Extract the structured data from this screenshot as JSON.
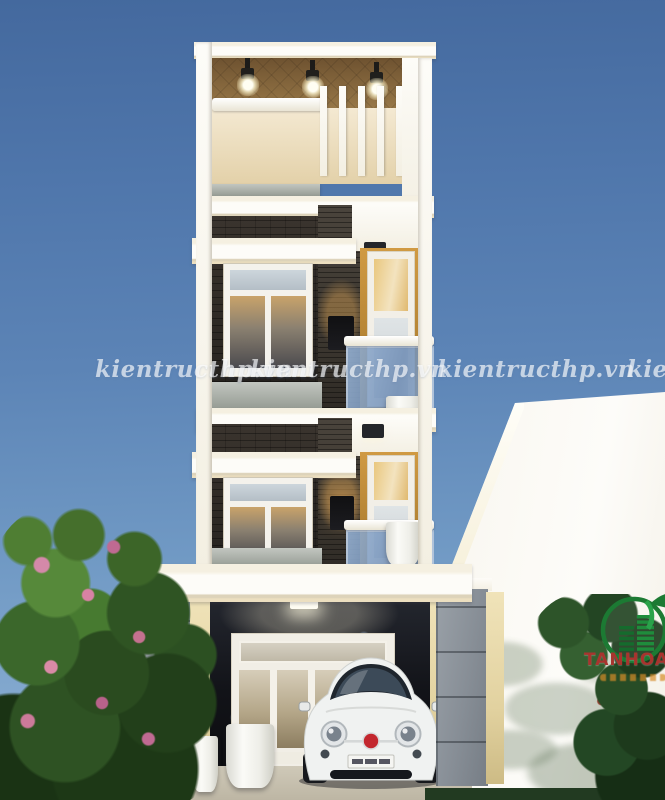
{
  "watermark": {
    "text": "kientructhp.vn",
    "count": 4
  },
  "brand": {
    "name": "TANHOANG"
  },
  "scene": {
    "subject": "modern 4-level tube house exterior render with carport",
    "colors": {
      "sky_top": "#44699e",
      "sky_bottom": "#9cbdda",
      "facade_white": "#fdfcf8",
      "ceiling_wood": "#8a6b3c",
      "accent_mustard": "#b68534",
      "brick_dark": "#332e29",
      "glass_blue": "#7e9cc0",
      "pillar_stone": "#8e959c",
      "logo_green": "#1c7a33",
      "logo_text_red": "#a8342e",
      "watermark_white": "rgba(255,255,255,0.65)"
    }
  }
}
